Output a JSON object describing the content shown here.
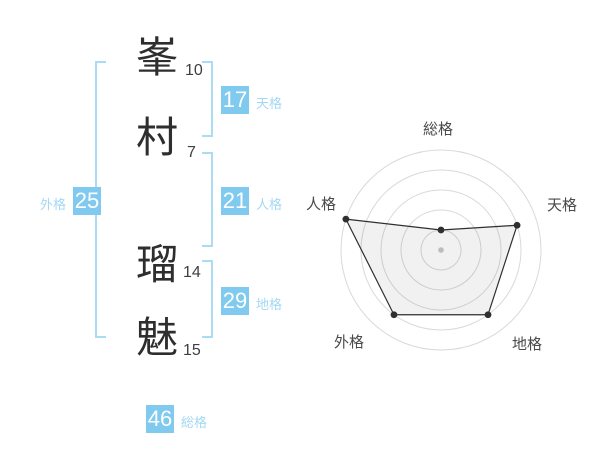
{
  "name_panel": {
    "characters": [
      {
        "char": "峯",
        "strokes": "10"
      },
      {
        "char": "村",
        "strokes": "7"
      },
      {
        "char": "瑠",
        "strokes": "14"
      },
      {
        "char": "魅",
        "strokes": "15"
      }
    ],
    "metrics": {
      "tenkaku": {
        "label": "天格",
        "value": "17"
      },
      "jinkaku": {
        "label": "人格",
        "value": "21"
      },
      "chikaku": {
        "label": "地格",
        "value": "29"
      },
      "gaikaku": {
        "label": "外格",
        "value": "25"
      },
      "soukaku": {
        "label": "総格",
        "value": "46"
      }
    }
  },
  "colors": {
    "chip_bg": "#7fcaee",
    "label_blue": "#a3d8f4",
    "bracket_blue": "#abdcf6",
    "kanji_ink": "#2e2e2e",
    "chart_grid": "#d9d9d9",
    "chart_line": "#2f2f2f",
    "chart_label": "#4a4a4a"
  },
  "chart_data": {
    "type": "radar",
    "categories": [
      "総格",
      "天格",
      "地格",
      "外格",
      "人格"
    ],
    "values": [
      1,
      4,
      4,
      4,
      5
    ],
    "max": 5,
    "rings": 5,
    "grid": "concentric-circles",
    "legend": "none",
    "order": "clockwise-from-top",
    "fill": "light-gray-translucent"
  }
}
